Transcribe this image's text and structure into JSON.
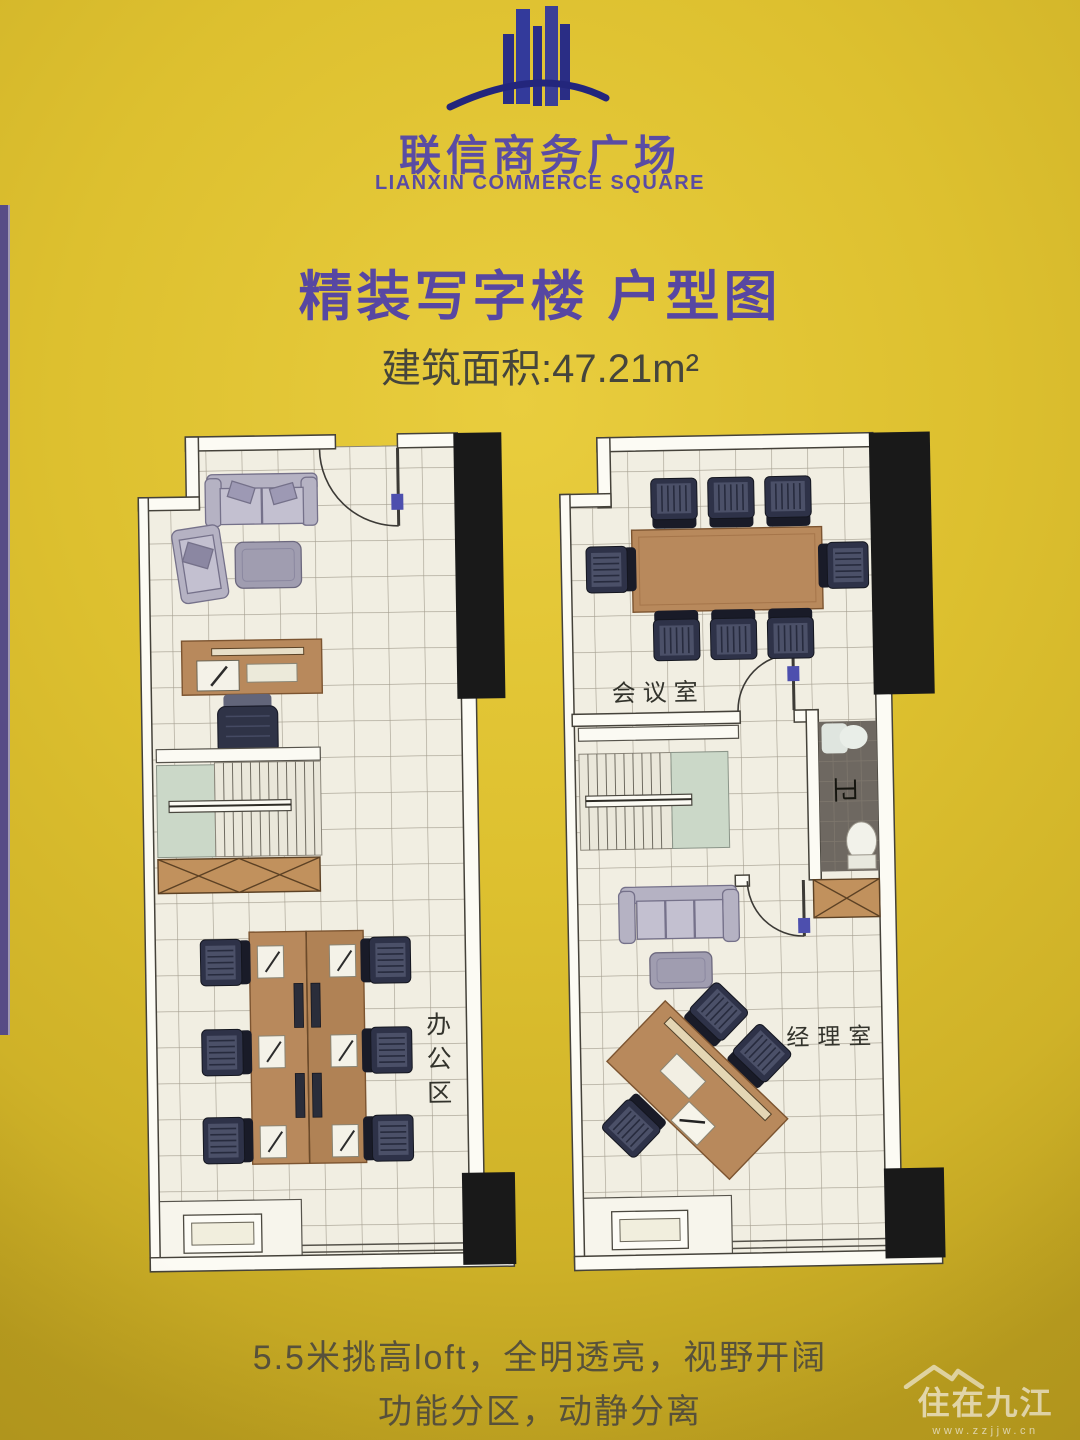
{
  "brand": {
    "name_cn": "联信商务广场",
    "name_en": "LIANXIN COMMERCE SQUARE"
  },
  "header": {
    "title": "精装写字楼 户型图",
    "area": "建筑面积:47.21m²"
  },
  "plans": {
    "left": {
      "labels": {
        "office": "办公区"
      }
    },
    "right": {
      "labels": {
        "meeting": "会议室",
        "bathroom": "卫",
        "manager": "经理室"
      }
    }
  },
  "footer": {
    "line1": "5.5米挑高loft，全明透亮，视野开阔",
    "line2": "功能分区，动静分离"
  },
  "watermark": {
    "site_name": "住在九江",
    "site_url": "www.zzjjw.cn"
  },
  "colors": {
    "background_yellow": "#ddc02f",
    "brand_purple": "#5a4ca4",
    "title_purple": "#5747a2",
    "area_text": "#45453c",
    "plan_floor": "#f1eee2",
    "wall_black": "#191919",
    "furniture_wood": "#b8895c",
    "chair_dark": "#2e3248",
    "stair_green": "#cbd8c8",
    "hatch_tan": "#c1915d",
    "bathroom_gray": "#6e6861",
    "door_handle_blue": "#4d4fae",
    "footer_text": "#57513b",
    "watermark_cream": "#ece2bd"
  }
}
